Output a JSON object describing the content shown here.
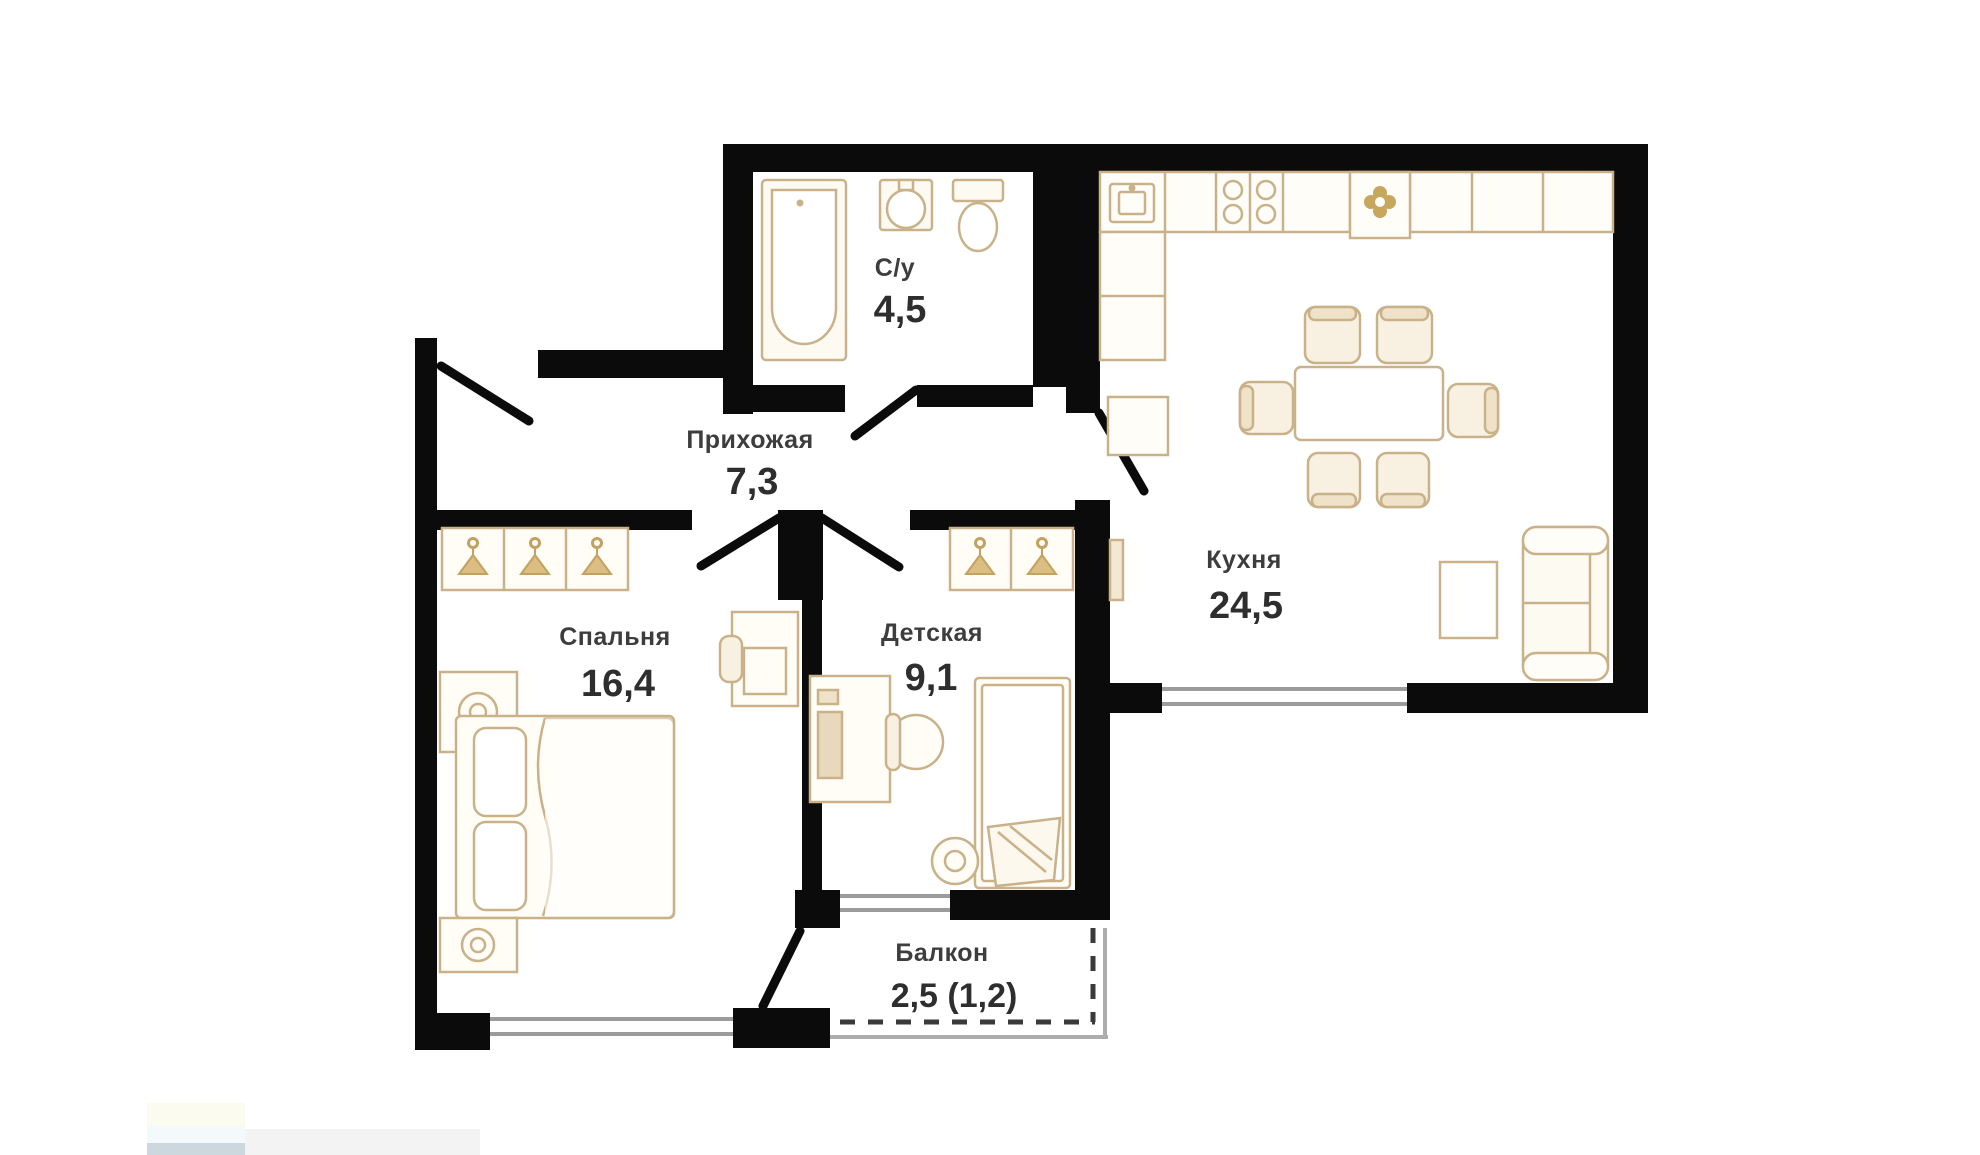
{
  "plan": {
    "title": "2-room apartment floor plan",
    "rooms": [
      {
        "key": "bathroom",
        "label": "С/у",
        "area": "4,5"
      },
      {
        "key": "hallway",
        "label": "Прихожая",
        "area": "7,3"
      },
      {
        "key": "kitchen",
        "label": "Кухня",
        "area": "24,5"
      },
      {
        "key": "bedroom",
        "label": "Спальня",
        "area": "16,4"
      },
      {
        "key": "children",
        "label": "Детская",
        "area": "9,1"
      },
      {
        "key": "balcony",
        "label": "Балкон",
        "area": "2,5 (1,2)"
      }
    ],
    "fixtures": [
      "bathtub-icon",
      "sink-icon",
      "toilet-icon",
      "kitchen-counter",
      "kitchen-sink-icon",
      "stove-burners-icon",
      "plant-icon",
      "fridge",
      "dining-table",
      "chair",
      "sofa",
      "side-table",
      "wardrobe",
      "clothes-hanger-icon",
      "double-bed",
      "nightstand",
      "lamp-icon",
      "desk",
      "desk-chair",
      "single-bed",
      "pillow",
      "stool",
      "radiator",
      "window",
      "door-swing"
    ],
    "colors": {
      "wall": "#0b0b0b",
      "furniture_stroke": "#c9b189",
      "furniture_fill": "#fdfaf2",
      "hanger_fill": "#dcbd84",
      "window_line": "#9b9b9b",
      "label_text": "#3d3d3d",
      "area_text": "#2e2e2e",
      "balcony_dash": "#3a3a3a"
    }
  }
}
